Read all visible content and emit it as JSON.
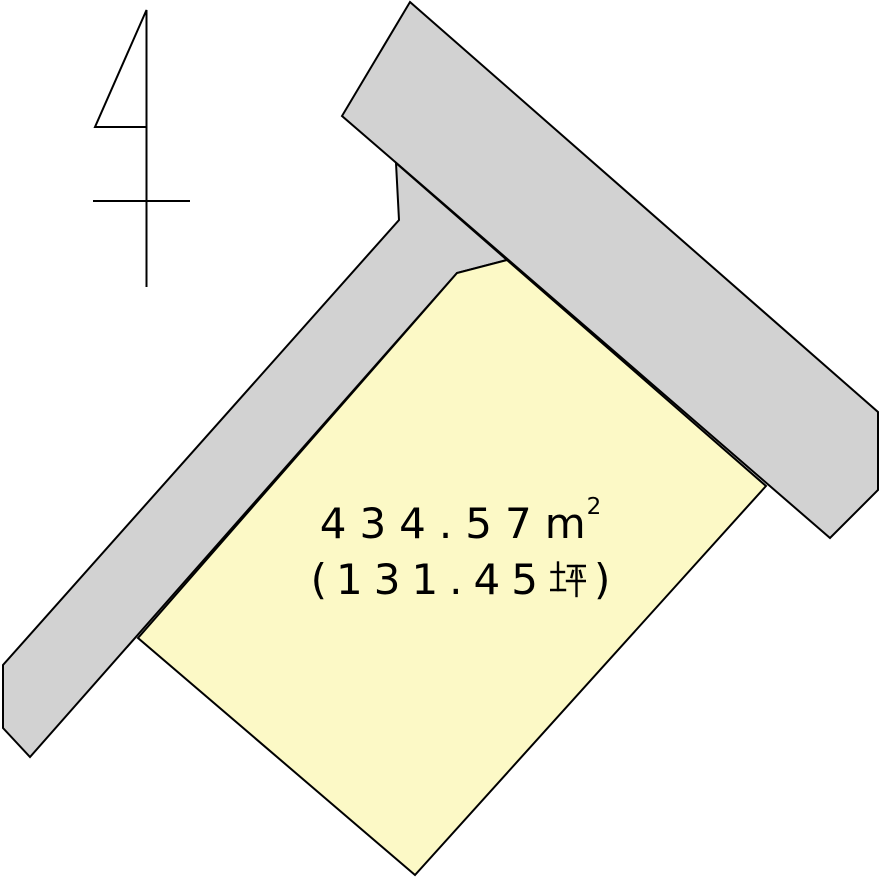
{
  "canvas": {
    "width": 881,
    "height": 877,
    "background": "#ffffff"
  },
  "colors": {
    "road_fill": "#d2d2d2",
    "parcel_fill": "#fcf9c6",
    "outline": "#000000",
    "text": "#000000"
  },
  "parcel": {
    "area_sqm_display": "４３４.５７㎡",
    "area_tsubo_display": "（１３１.４５坪）",
    "area_sqm_value": "434.57",
    "area_sqm_unit_base": "m",
    "area_sqm_unit_exponent": "2",
    "area_tsubo_open_paren": "(",
    "area_tsubo_value": "131.45",
    "area_tsubo_unit": "坪",
    "area_tsubo_close_paren": ")"
  }
}
